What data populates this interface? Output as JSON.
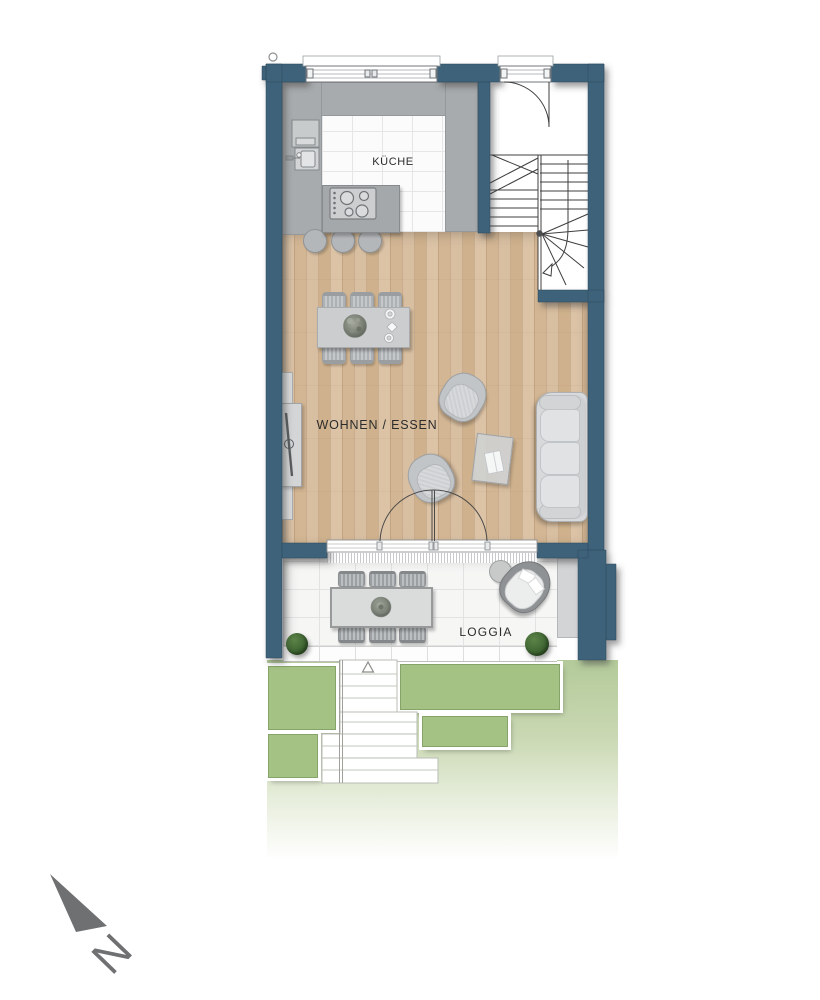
{
  "plan": {
    "type": "floorplan-ground-floor",
    "rooms": [
      {
        "id": "kitchen",
        "label": "KÜCHE"
      },
      {
        "id": "living-dining",
        "label": "WOHNEN / ESSEN"
      },
      {
        "id": "loggia",
        "label": "LOGGIA"
      }
    ],
    "compass": {
      "label": "N",
      "direction": "north-west"
    },
    "palette": {
      "wall": "#3e6279",
      "wood": "#d8bd9e",
      "counter": "#a8abad",
      "gardenGreen": "#a4c284",
      "gardenLight": "#b3ca9a",
      "northArrow": "#6f7072",
      "ink": "#2c2c2c"
    },
    "furniture": {
      "kitchen": [
        "counter-l-shape",
        "tall-units",
        "island-with-cooktop",
        "sink",
        "3-bar-stools"
      ],
      "living": [
        "dining-table-6-chairs",
        "tv-sideboard",
        "2-armchairs",
        "coffee-table",
        "sofa-3-seat"
      ],
      "loggia": [
        "outdoor-table-6-chairs",
        "lounge-chair",
        "side-table",
        "2-plants"
      ],
      "garden": [
        "terraced-steps",
        "4-planting-beds"
      ]
    }
  }
}
